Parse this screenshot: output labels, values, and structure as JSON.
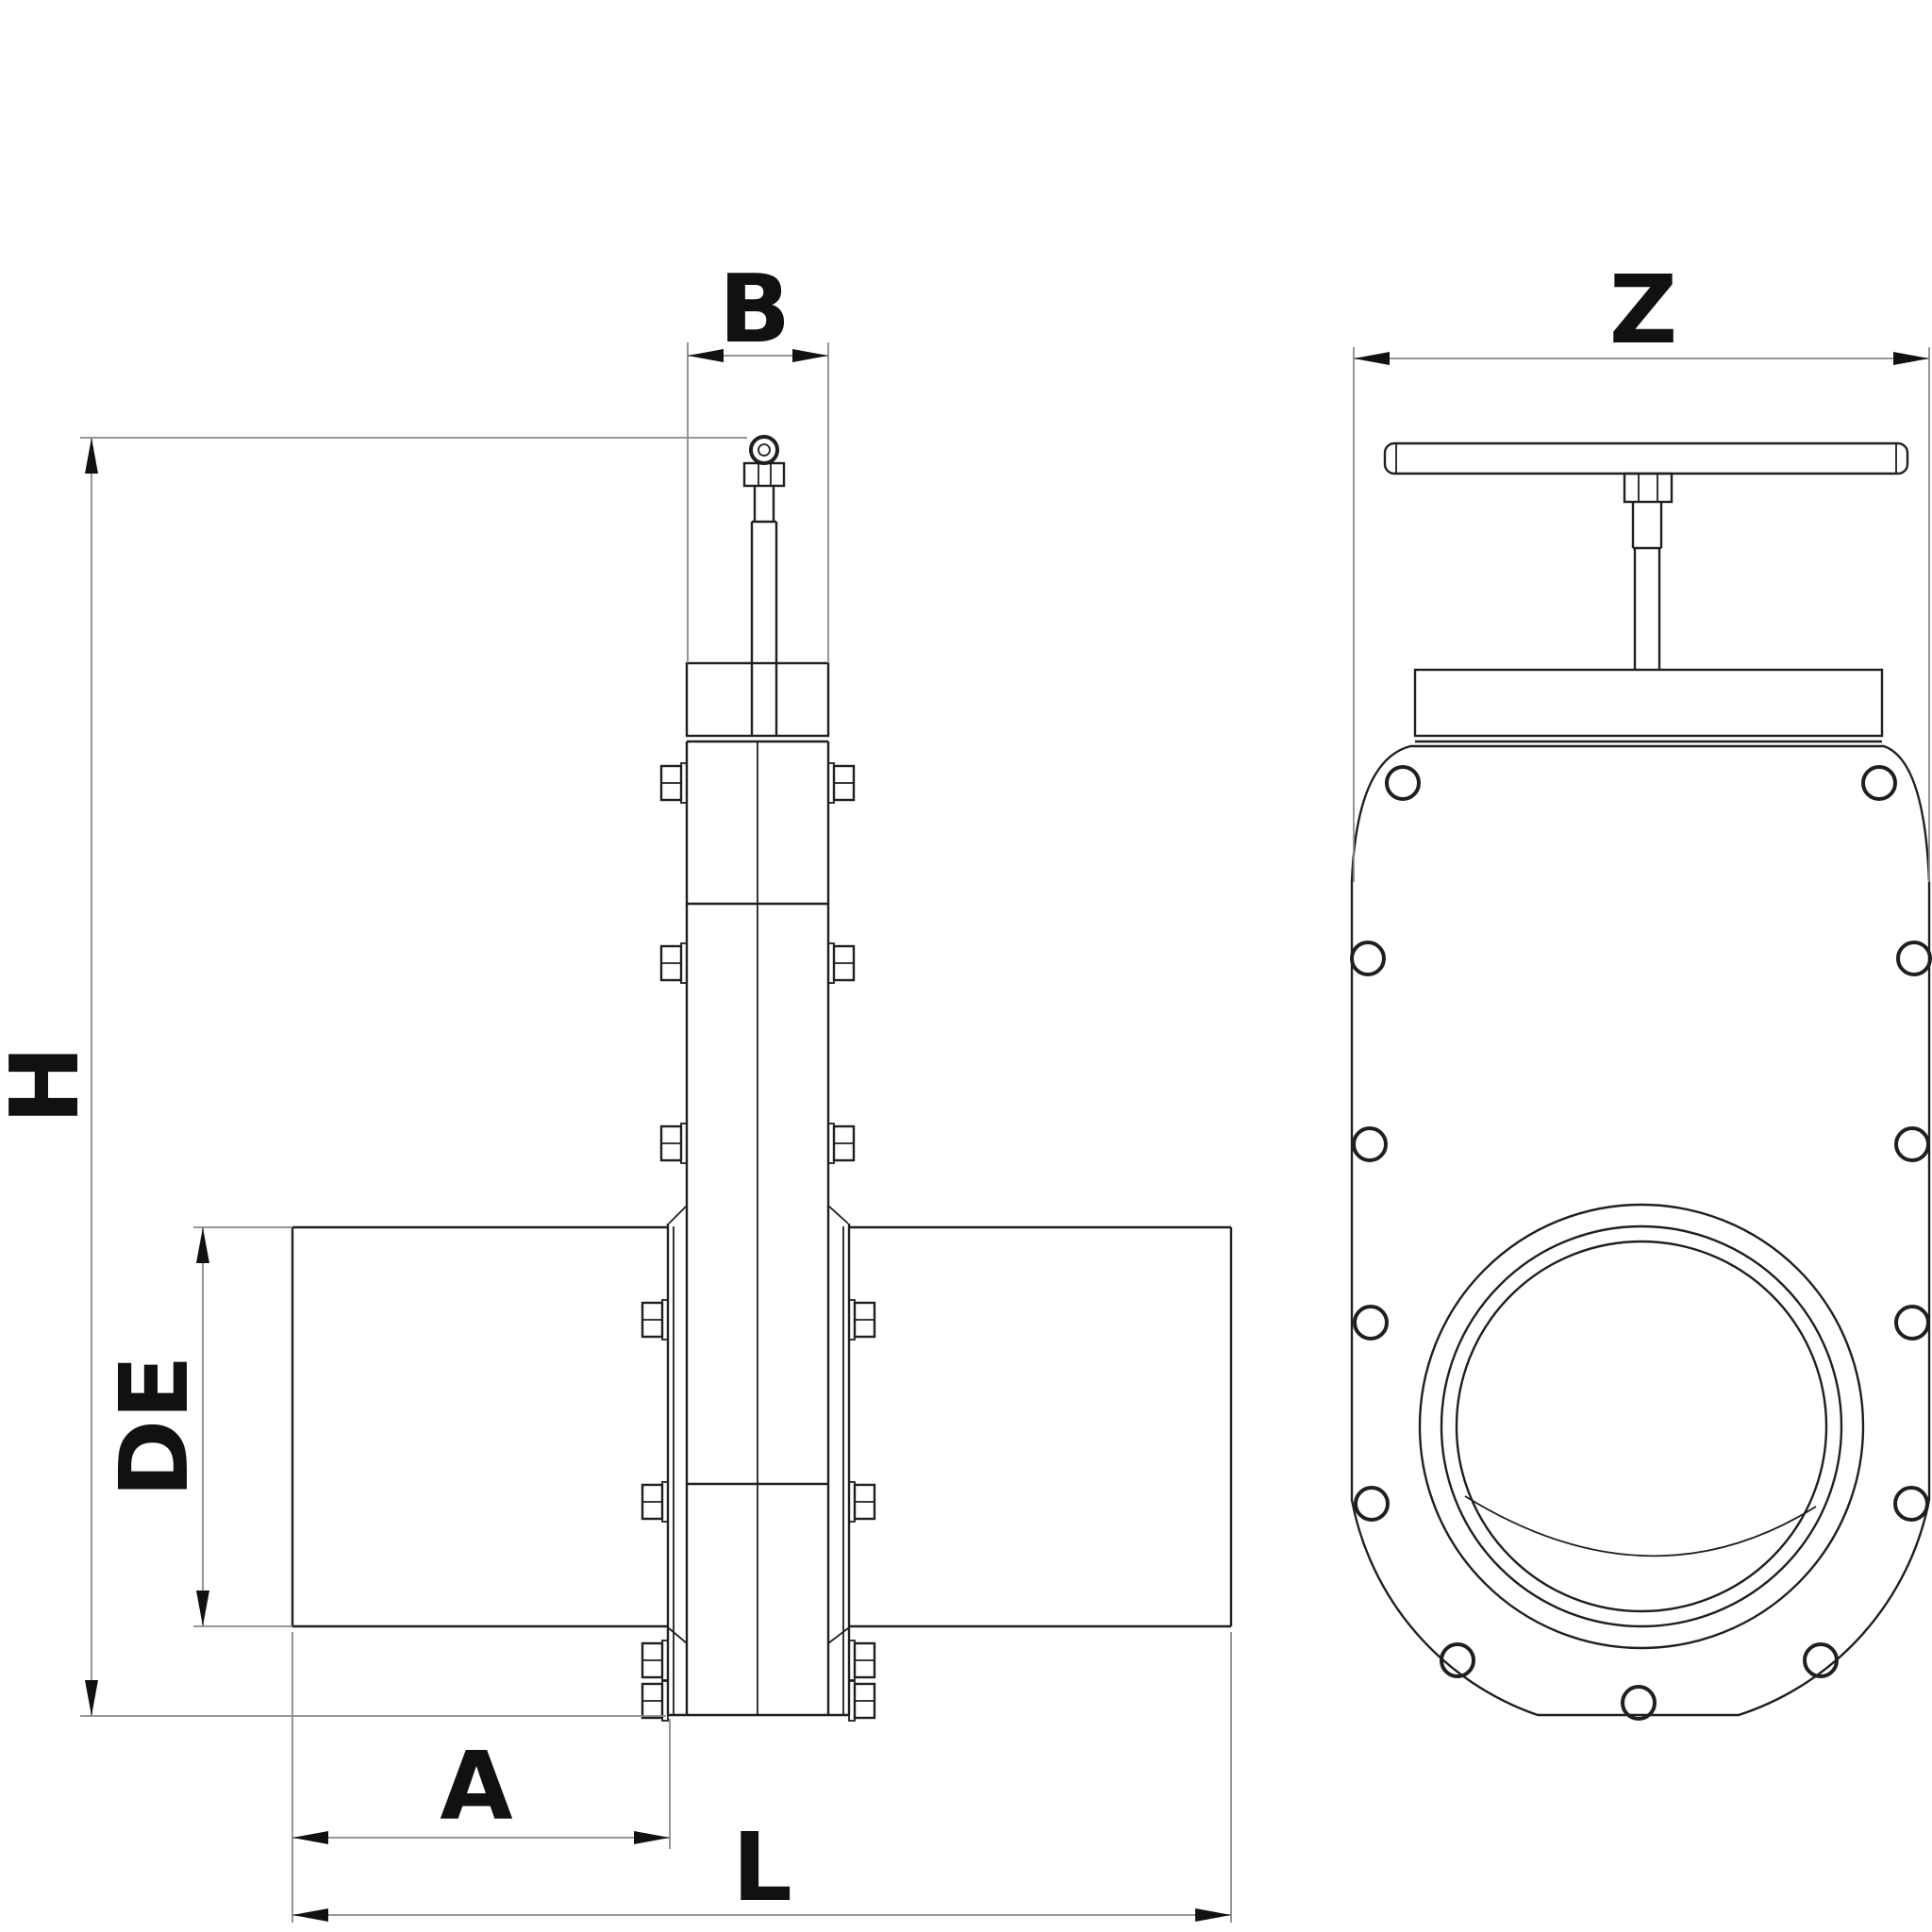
{
  "drawing": {
    "type": "technical-drawing",
    "subject": "knife-gate-valve-two-views",
    "views": {
      "side_view": "valve side elevation with pipe, bonnet, stem and eye bolt",
      "front_view": "valve front elevation with handwheel bar, bolt holes and bore"
    },
    "dimension_labels": {
      "B": "B",
      "Z": "Z",
      "H": "H",
      "DE": "DE",
      "A": "A",
      "L": "L"
    },
    "colors": {
      "background": "#ffffff",
      "object_line": "#1f1f1f",
      "dimension_line": "#8a8a8a",
      "label": "#111111"
    }
  }
}
